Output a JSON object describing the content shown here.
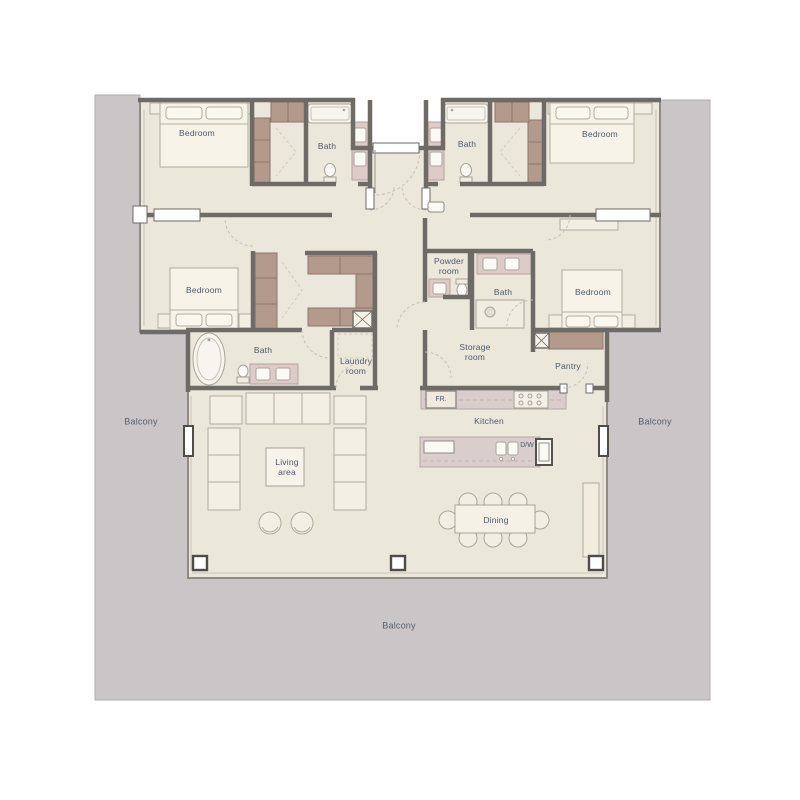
{
  "rooms": {
    "bedroom_top_left": "Bedroom",
    "bath_top_left": "Bath",
    "bedroom_top_right": "Bedroom",
    "bath_top_right": "Bath",
    "bedroom_mid_left": "Bedroom",
    "powder_room": "Powder\nroom",
    "bath_mid_right": "Bath",
    "bedroom_mid_right": "Bedroom",
    "bath_master": "Bath",
    "laundry_room": "Laundry\nroom",
    "storage_room": "Storage\nroom",
    "pantry": "Pantry",
    "kitchen": "Kitchen",
    "living_area": "Living\narea",
    "dining": "Dining",
    "balcony_left": "Balcony",
    "balcony_right": "Balcony",
    "balcony_bottom": "Balcony"
  },
  "appliances": {
    "fridge": "FR.",
    "dishwasher": "D/W"
  },
  "colors": {
    "floor": "#ece7db",
    "balcony": "#cac6c7",
    "wall": "#6e6a66",
    "closet": "#b49a8c",
    "counter": "#d9cecb",
    "vanity": "#dccbc7",
    "label_text": "#4d5866"
  }
}
